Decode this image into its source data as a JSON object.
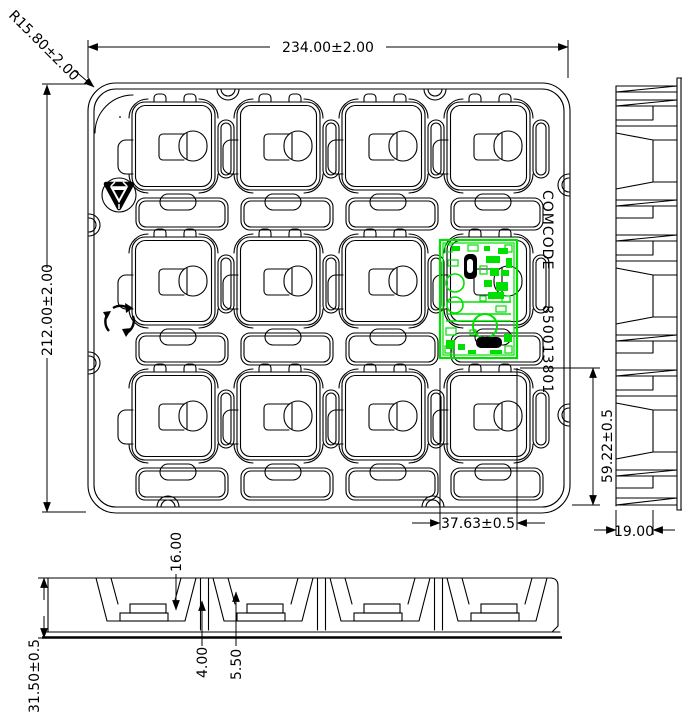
{
  "drawing": {
    "type": "thermoformed packaging tray - engineering drawing",
    "colors": {
      "line": "#000000",
      "background": "#ffffff",
      "pcb": "#00e000"
    },
    "tray": {
      "pocket_rows": 3,
      "pocket_columns": 4
    },
    "labels": {
      "radius": "R15.80±2.00",
      "width": "234.00±2.00",
      "height": "212.00±2.00",
      "comcode": "COMCODE",
      "part_number": "850013801",
      "pocket_y": "59.22±0.5",
      "pocket_x": "37.63±0.5",
      "side_width": "19.00",
      "cavity_depth": "16.00",
      "step_a": "4.00",
      "step_b": "5.50",
      "overall_height": "31.50±0.5"
    },
    "icons": [
      "recycle-triangle-icon",
      "recycle-loop-icon"
    ]
  }
}
